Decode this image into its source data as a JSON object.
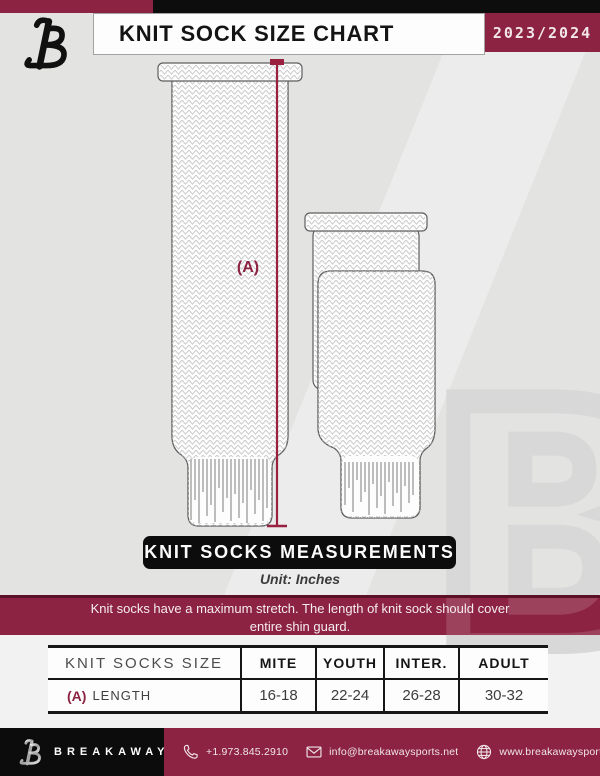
{
  "header": {
    "title": "KNIT SOCK SIZE CHART",
    "season": "2023/2024"
  },
  "diagram": {
    "measure_label": "(A)",
    "banner_title": "KNIT SOCKS MEASUREMENTS",
    "unit_note": "Unit: Inches"
  },
  "notice": {
    "line1": "Knit socks have a maximum stretch. The length of knit sock should cover",
    "line2": "entire shin guard."
  },
  "size_table": {
    "columns": [
      "KNIT SOCKS SIZE",
      "MITE",
      "YOUTH",
      "INTER.",
      "ADULT"
    ],
    "rows": [
      {
        "prefix": "(A)",
        "label": "LENGTH",
        "values": [
          "16-18",
          "22-24",
          "26-28",
          "30-32"
        ]
      }
    ]
  },
  "footer": {
    "brand": "BREAKAWAY",
    "phone": "+1.973.845.2910",
    "email": "info@breakawaysports.net",
    "website": "www.breakawaysports.net"
  },
  "colors": {
    "maroon": "#8c2342",
    "black": "#0d0d0d",
    "bg_gray": "#e3e4e2",
    "measure_line": "#9a2040"
  }
}
